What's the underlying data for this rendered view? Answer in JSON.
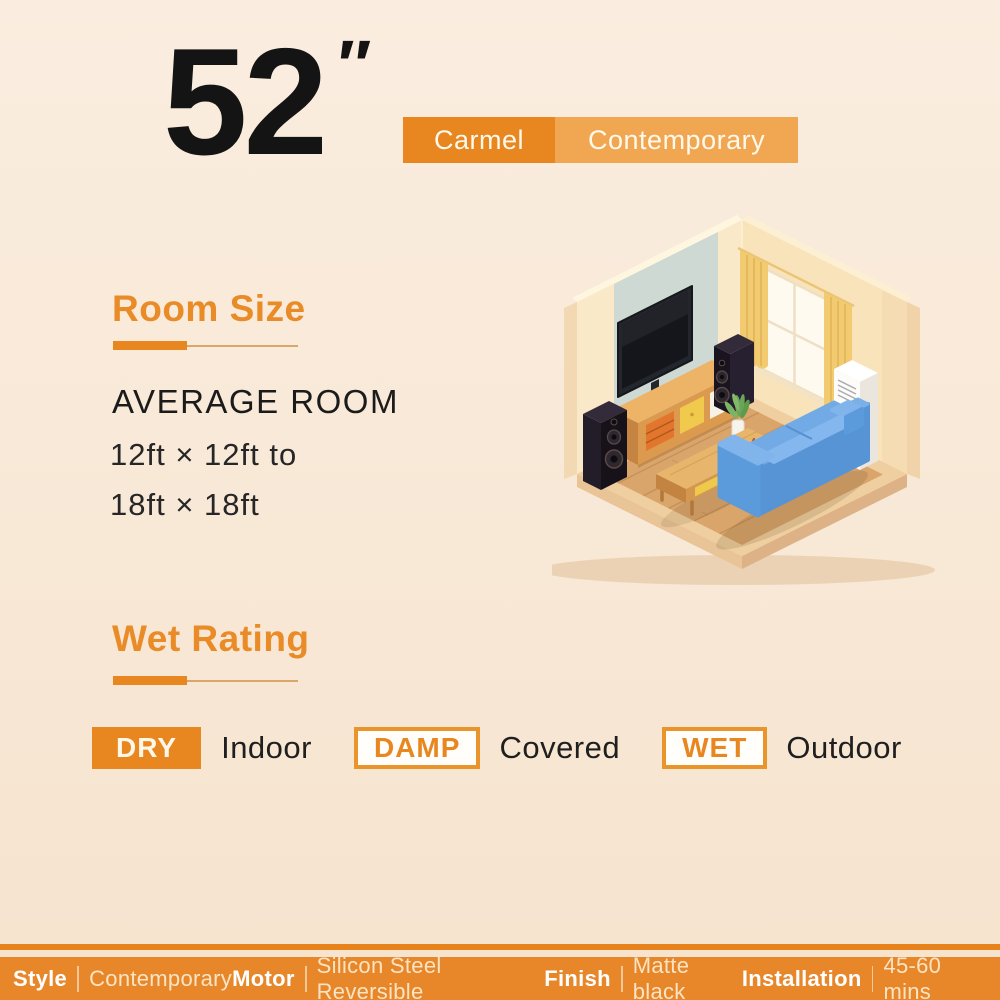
{
  "product": {
    "size_value": "52",
    "size_unit": "″"
  },
  "badges": {
    "series": "Carmel",
    "style": "Contemporary"
  },
  "room_size": {
    "heading": "Room Size",
    "subheading": "AVERAGE ROOM",
    "range_line1": "12ft × 12ft to",
    "range_line2": "18ft × 18ft"
  },
  "wet_rating": {
    "heading": "Wet Rating",
    "items": [
      {
        "badge": "DRY",
        "variant": "filled",
        "label": "Indoor"
      },
      {
        "badge": "DAMP",
        "variant": "outline",
        "label": "Covered"
      },
      {
        "badge": "WET",
        "variant": "outline",
        "label": "Outdoor"
      }
    ]
  },
  "illustration": {
    "description": "Isometric living room with wall-mounted TV, tower speakers, wooden TV cabinet, coffee table, potted plant, cat, blue sofa, window with yellow curtains and white floor-standing unit"
  },
  "specs_bar": {
    "items": [
      {
        "label": "Style",
        "value": "Contemporary"
      },
      {
        "label": "Motor",
        "value": "Silicon Steel Reversible"
      },
      {
        "label": "Finish",
        "value": "Matte black"
      },
      {
        "label": "Installation",
        "value": "45-60 mins"
      }
    ]
  },
  "colors": {
    "background": "#F8E8D6",
    "accent_orange": "#E8861F",
    "accent_orange_light": "#F1A652",
    "heading_orange": "#E98B26",
    "bar_orange": "#E8872A",
    "text_black": "#1B1B1B"
  }
}
